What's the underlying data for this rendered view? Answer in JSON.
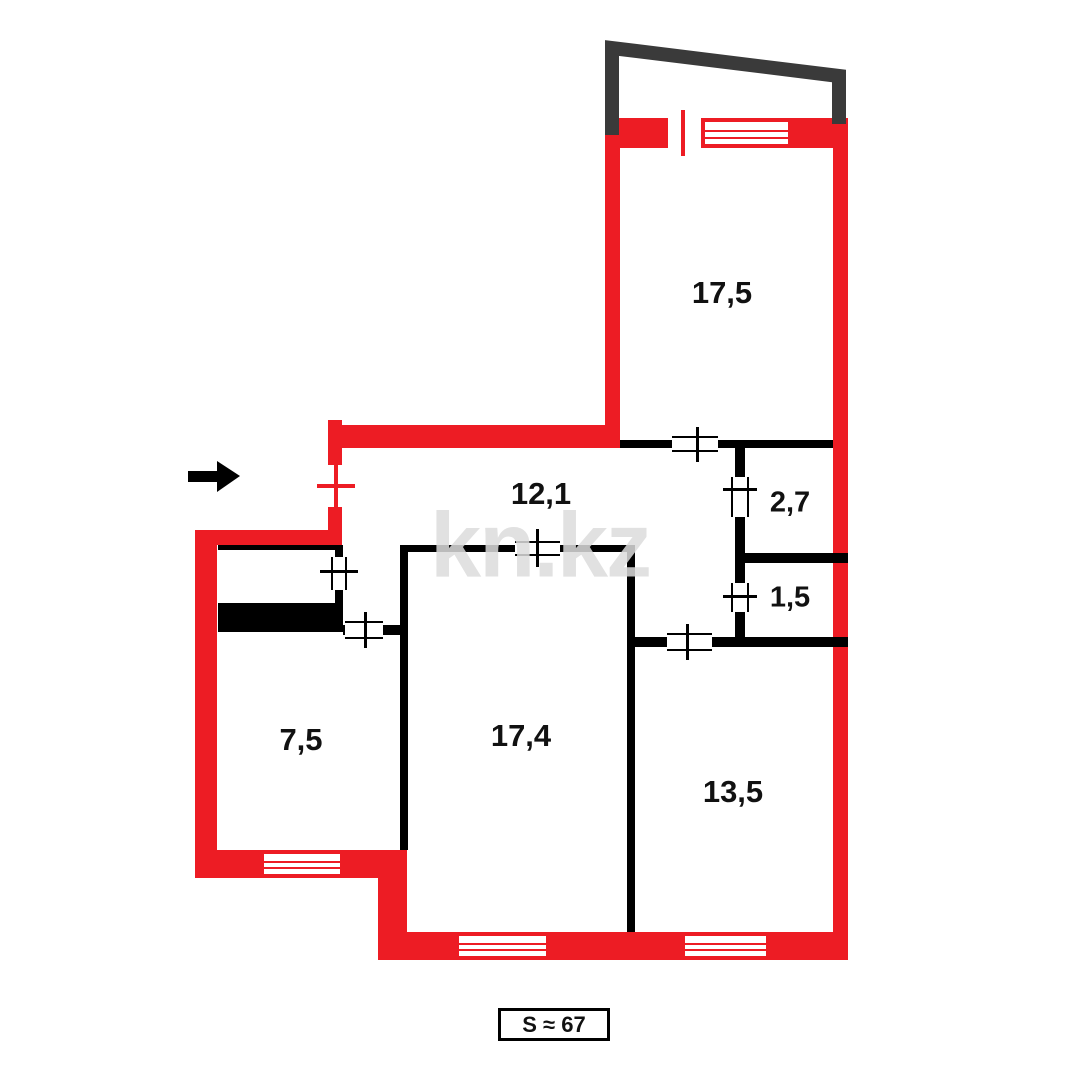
{
  "plan": {
    "watermark_text": "kn.kz",
    "total_area": "S ≈ 67",
    "rooms": [
      {
        "id": "room-top",
        "area": "17,5"
      },
      {
        "id": "hallway",
        "area": "12,1"
      },
      {
        "id": "closet-upper",
        "area": "2,7"
      },
      {
        "id": "closet-lower",
        "area": "1,5"
      },
      {
        "id": "room-left",
        "area": "7,5"
      },
      {
        "id": "room-middle",
        "area": "17,4"
      },
      {
        "id": "room-right",
        "area": "13,5"
      }
    ]
  },
  "colors": {
    "exterior_wall": "#ed1c24",
    "interior_wall": "#000000",
    "balcony_outline": "#3a3a3a",
    "watermark": "#dcdcdc",
    "label_text": "#111111"
  },
  "icons": {
    "entrance_arrow": "arrow-right"
  }
}
